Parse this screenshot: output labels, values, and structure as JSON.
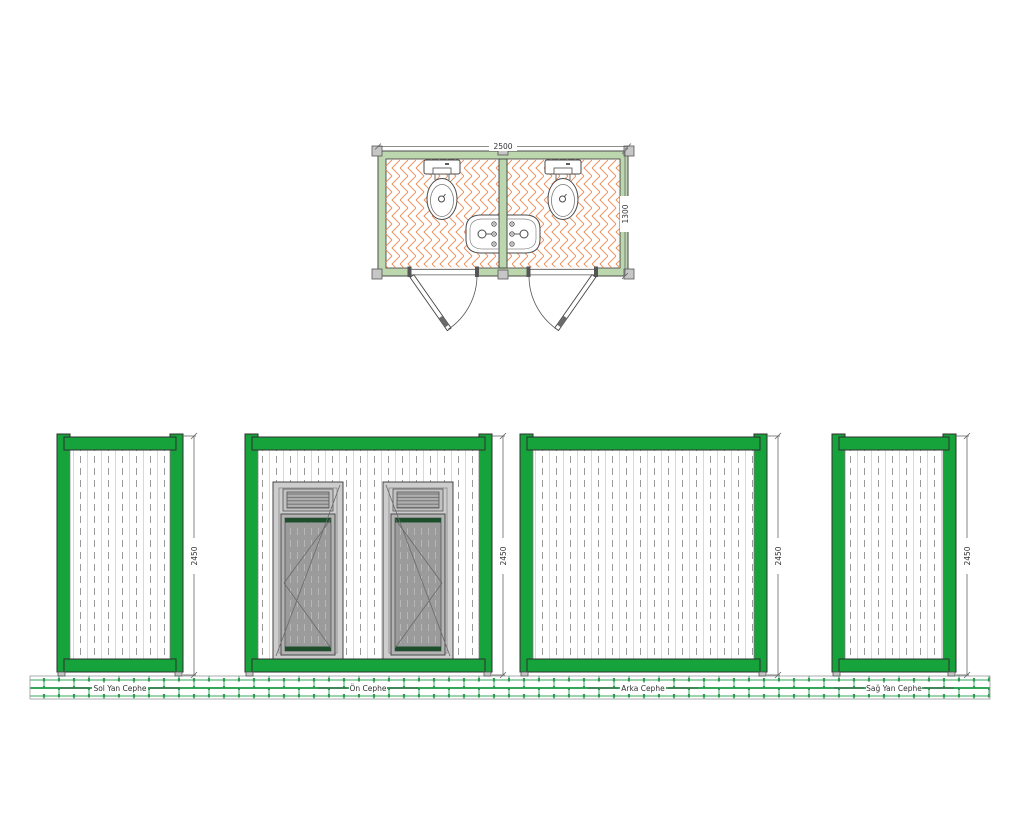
{
  "plan": {
    "name": "WC container floor plan",
    "width_dim": "2500",
    "depth_dim": "1300"
  },
  "elevations": {
    "sol": {
      "label": "Sol Yan Cephe",
      "height_dim": "2450"
    },
    "on": {
      "label": "Ön Cephe",
      "height_dim": "2450"
    },
    "arka": {
      "label": "Arka Cephe",
      "height_dim": "2450"
    },
    "sag": {
      "label": "Sağ Yan Cephe",
      "height_dim": "2450"
    }
  },
  "colors": {
    "frame_green": "#17a33c",
    "plan_wall_green": "#bcd6ae",
    "floor_tile_orange": "#ee8a55",
    "ground_brick_green": "#35a85c",
    "door_leaf_gray": "#9b9b9b",
    "door_trim_green": "#1d4f2d"
  }
}
